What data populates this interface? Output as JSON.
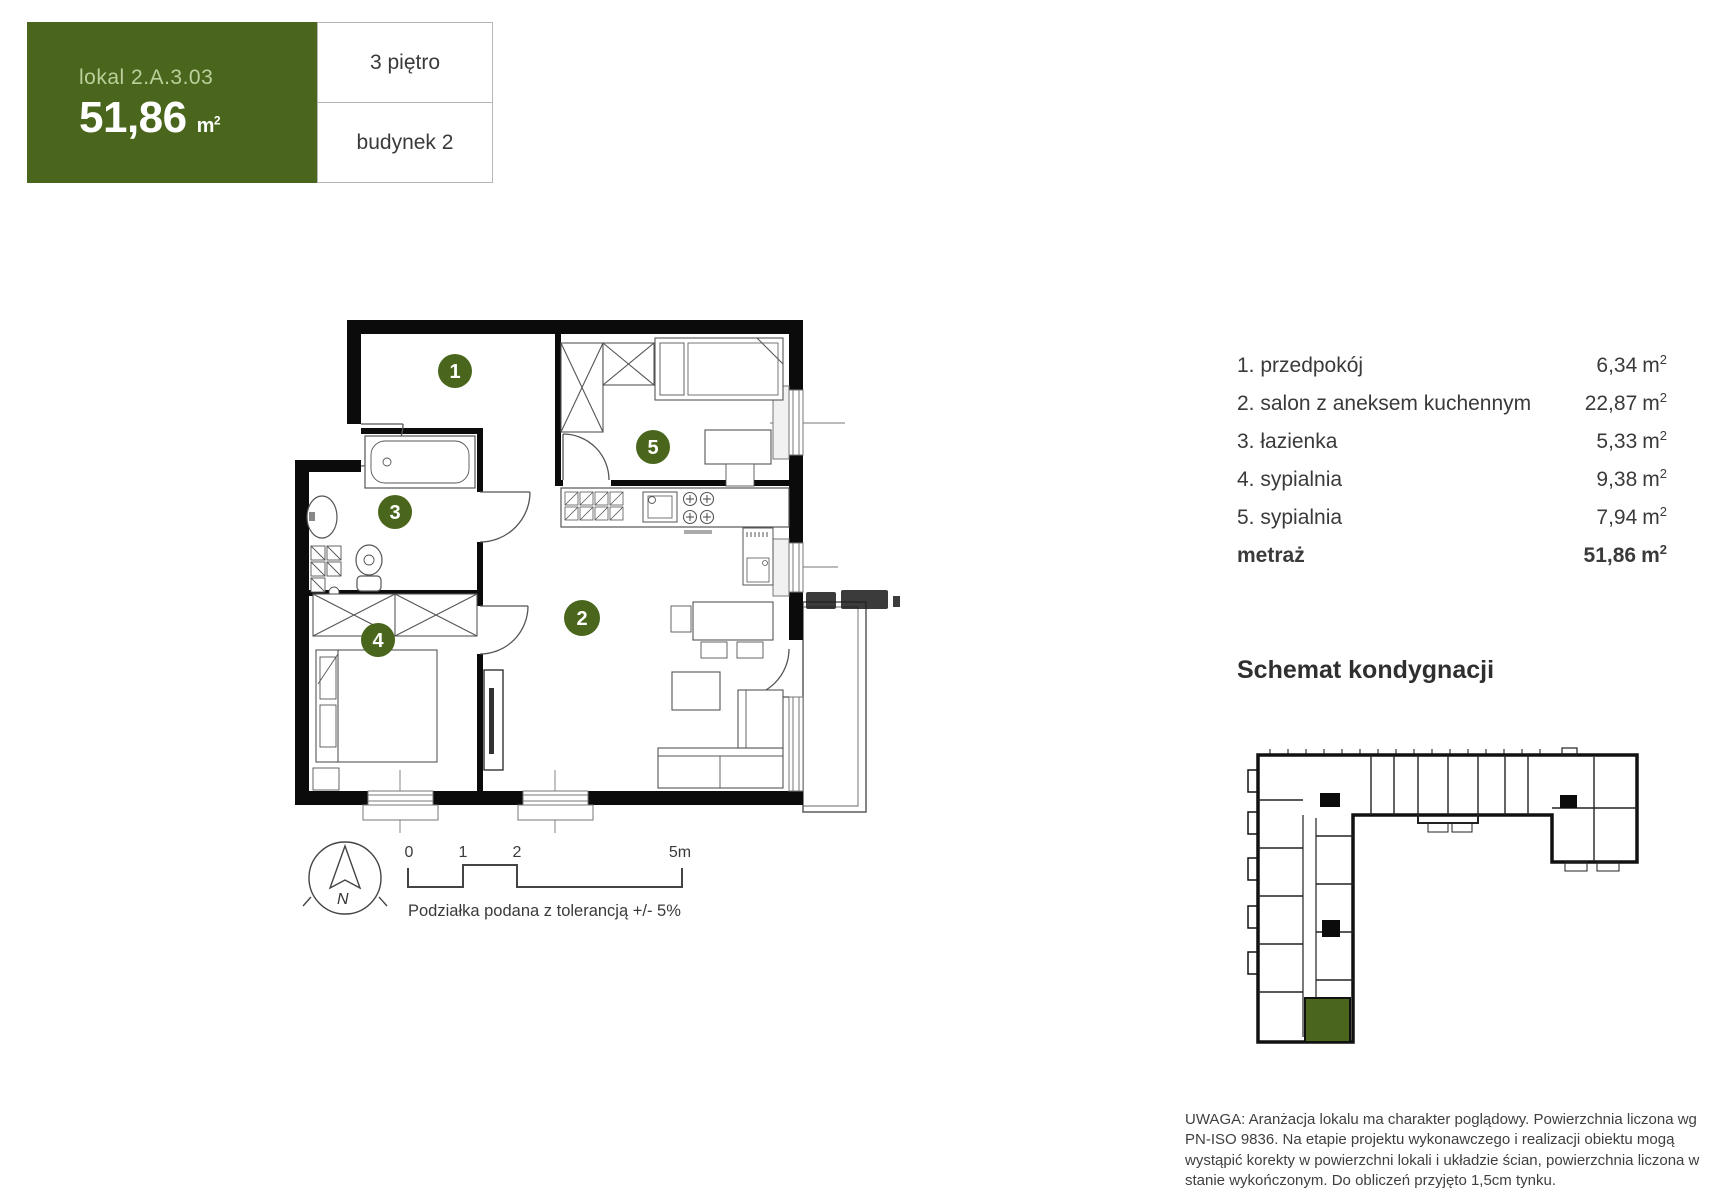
{
  "colors": {
    "accent_green": "#4a661c",
    "accent_green_text": "#bccf9c",
    "text_dark": "#3a3a3a",
    "wall_black": "#0b0b0b",
    "line_gray": "#555555"
  },
  "header": {
    "unit_prefix": "lokal",
    "unit_id": "2.A.3.03",
    "area_value": "51,86",
    "area_unit": "m",
    "area_exp": "2",
    "floor": "3 piętro",
    "building": "budynek 2"
  },
  "room_list": {
    "area_unit": "m",
    "area_exp": "2",
    "rows": [
      {
        "label": "1. przedpokój",
        "area": "6,34"
      },
      {
        "label": "2. salon z aneksem kuchennym",
        "area": "22,87"
      },
      {
        "label": "3. łazienka",
        "area": "5,33"
      },
      {
        "label": "4. sypialnia",
        "area": "9,38"
      },
      {
        "label": "5. sypialnia",
        "area": "7,94"
      }
    ],
    "total_label": "metraż",
    "total_area": "51,86"
  },
  "floor_plan": {
    "room_badges": [
      "1",
      "2",
      "3",
      "4",
      "5"
    ],
    "scale_bar": {
      "ticks": [
        "0",
        "1",
        "2",
        "5m"
      ],
      "note": "Podziałka podana z tolerancją +/- 5%"
    },
    "compass": {
      "label": "N"
    }
  },
  "schematic": {
    "heading": "Schemat kondygnacji"
  },
  "disclaimer": {
    "text": "UWAGA: Aranżacja lokalu ma charakter poglądowy. Powierzchnia liczona wg PN-ISO 9836. Na etapie projektu wykonawczego i realizacji obiektu mogą wystąpić korekty w powierzchni lokali i układzie ścian, powierzchnia liczona w stanie wykończonym. Do obliczeń przyjęto 1,5cm tynku."
  }
}
